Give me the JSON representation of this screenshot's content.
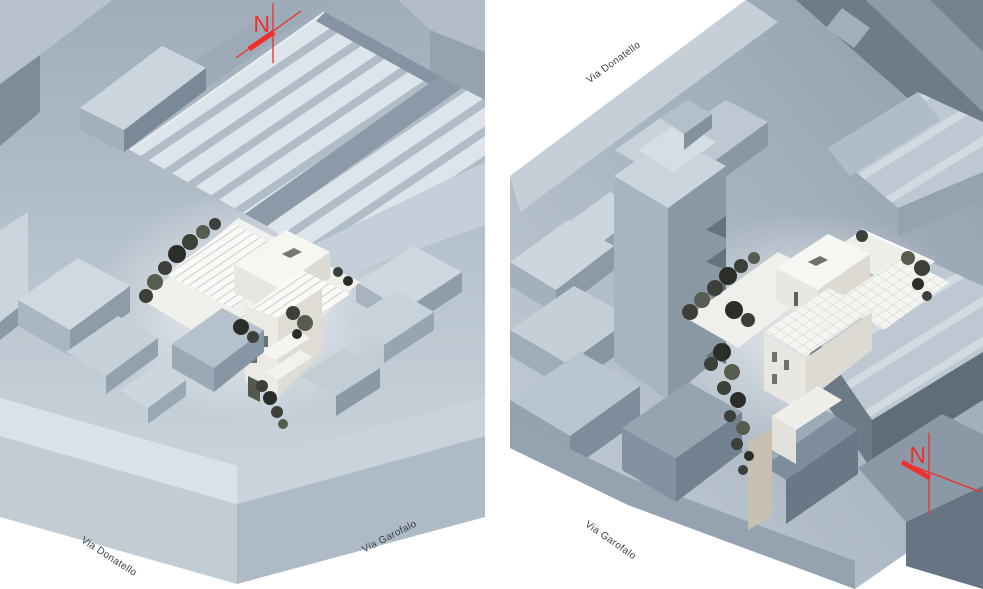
{
  "figure": {
    "background": "#ffffff",
    "palette": {
      "background": "#ffffff",
      "north_red": "#ee2f2c",
      "label_text": "#39404a",
      "project_white": "#f6f6f3",
      "vegetation_dark": "#3d403a",
      "context_light": "#ccd6de",
      "context_mid": "#a9b5c2",
      "context_dark": "#758493"
    },
    "views": [
      {
        "name": "left-axonometric-view",
        "north_letter": "N",
        "street_labels": [
          {
            "text": "Via Donatello",
            "placement": "bottom-left"
          },
          {
            "text": "Via Garofalo",
            "placement": "bottom-right"
          }
        ]
      },
      {
        "name": "right-axonometric-view",
        "north_letter": "N",
        "street_labels": [
          {
            "text": "Via Donatello",
            "placement": "top-left"
          },
          {
            "text": "Via Garofalo",
            "placement": "bottom-left"
          }
        ]
      }
    ]
  }
}
